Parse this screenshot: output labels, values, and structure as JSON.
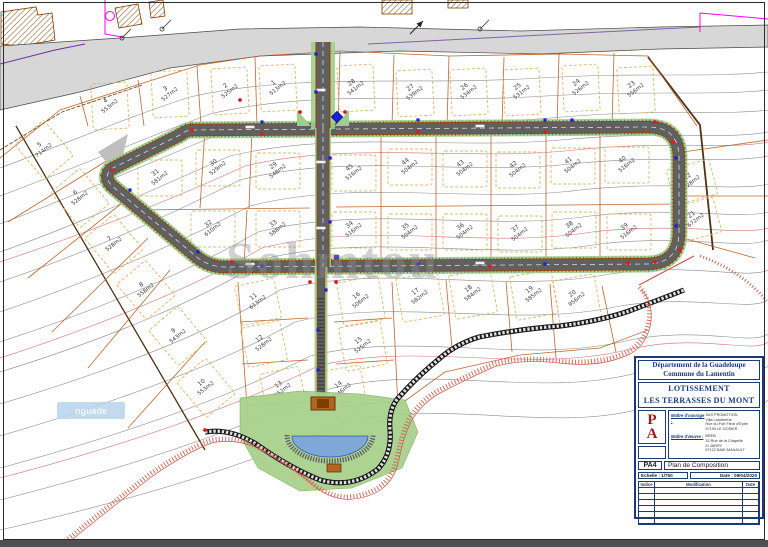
{
  "sheet": {
    "watermark_large": "Sohmtou",
    "watermark_chip": "nguade"
  },
  "title_block": {
    "department": "Département de la Guadeloupe",
    "commune": "Commune du Lamentin",
    "project_line1": "LOTISSEMENT",
    "project_line2": "LES TERRASSES DU MONT",
    "logo_top": "P",
    "logo_bottom": "A",
    "client_label": "Maître d'ouvrage :",
    "client_lines": [
      "SAS PROMOTION",
      "Villa Lamberthe",
      "Rue du Fort Fleur d'Epée",
      "97190 LE GOSIER"
    ],
    "designer_label": "Maître d'œuvre :",
    "designer_lines": [
      "BREB",
      "32 Rue de la Chapelle",
      "ZI JARRY",
      "97122 BAIE-MAHAULT"
    ],
    "doc_code": "PA4",
    "doc_title": "Plan de Composition",
    "scale_label": "Echelle : 1/750",
    "date_label": "Date : 09/04/2020",
    "rev_headers": [
      "Indice",
      "Modification",
      "Date"
    ]
  },
  "colors": {
    "existing_road": "#d7d7d7",
    "asphalt": "#606060",
    "curb_brown": "#8a4a16",
    "verge_green": "#9fce8a",
    "parcel_line": "#b4561e",
    "envelope": "#d9b468",
    "contour": "#666666",
    "contour_red": "#c0504d",
    "water": "#7fa8d9",
    "ravine_red": "#cc6659",
    "wall_black": "#161616",
    "navy": "#1b3a7a",
    "logo_red": "#9b1b1b",
    "magenta": "#ff00ff",
    "violet": "#7030a0"
  },
  "parcels": [
    {
      "n": "1",
      "a": "513m2",
      "x": 276,
      "y": 86
    },
    {
      "n": "2",
      "a": "525m2",
      "x": 228,
      "y": 89
    },
    {
      "n": "3",
      "a": "527m2",
      "x": 168,
      "y": 92
    },
    {
      "n": "4",
      "a": "553m2",
      "x": 108,
      "y": 104
    },
    {
      "n": "5",
      "a": "714m2",
      "x": 42,
      "y": 148
    },
    {
      "n": "6",
      "a": "528m2",
      "x": 78,
      "y": 196
    },
    {
      "n": "7",
      "a": "528m2",
      "x": 112,
      "y": 242
    },
    {
      "n": "8",
      "a": "558m2",
      "x": 144,
      "y": 288
    },
    {
      "n": "9",
      "a": "543m2",
      "x": 176,
      "y": 334
    },
    {
      "n": "10",
      "a": "553m2",
      "x": 204,
      "y": 386
    },
    {
      "n": "11",
      "a": "613m2",
      "x": 256,
      "y": 300
    },
    {
      "n": "12",
      "a": "528m2",
      "x": 262,
      "y": 342
    },
    {
      "n": "13",
      "a": "552m2",
      "x": 281,
      "y": 388
    },
    {
      "n": "14",
      "a": "546m2",
      "x": 341,
      "y": 388
    },
    {
      "n": "15",
      "a": "525m2",
      "x": 361,
      "y": 344
    },
    {
      "n": "16",
      "a": "506m2",
      "x": 359,
      "y": 299
    },
    {
      "n": "17",
      "a": "582m2",
      "x": 418,
      "y": 295
    },
    {
      "n": "18",
      "a": "584m2",
      "x": 471,
      "y": 292
    },
    {
      "n": "19",
      "a": "585m2",
      "x": 532,
      "y": 293
    },
    {
      "n": "20",
      "a": "956m2",
      "x": 575,
      "y": 297
    },
    {
      "n": "21",
      "a": "672m2",
      "x": 694,
      "y": 218
    },
    {
      "n": "22",
      "a": "528m2",
      "x": 690,
      "y": 180
    },
    {
      "n": "23",
      "a": "556m2",
      "x": 634,
      "y": 88
    },
    {
      "n": "24",
      "a": "526m2",
      "x": 579,
      "y": 86
    },
    {
      "n": "25",
      "a": "531m2",
      "x": 520,
      "y": 90
    },
    {
      "n": "26",
      "a": "534m2",
      "x": 467,
      "y": 90
    },
    {
      "n": "27",
      "a": "539m2",
      "x": 413,
      "y": 91
    },
    {
      "n": "28",
      "a": "541m2",
      "x": 354,
      "y": 86
    },
    {
      "n": "29",
      "a": "548m2",
      "x": 276,
      "y": 169
    },
    {
      "n": "30",
      "a": "529m2",
      "x": 216,
      "y": 166
    },
    {
      "n": "31",
      "a": "581m2",
      "x": 158,
      "y": 176
    },
    {
      "n": "32",
      "a": "610m2",
      "x": 211,
      "y": 227
    },
    {
      "n": "33",
      "a": "588m2",
      "x": 276,
      "y": 227
    },
    {
      "n": "34",
      "a": "516m2",
      "x": 352,
      "y": 228
    },
    {
      "n": "35",
      "a": "504m2",
      "x": 408,
      "y": 230
    },
    {
      "n": "36",
      "a": "504m2",
      "x": 463,
      "y": 230
    },
    {
      "n": "37",
      "a": "504m2",
      "x": 518,
      "y": 232
    },
    {
      "n": "38",
      "a": "504m2",
      "x": 572,
      "y": 228
    },
    {
      "n": "39",
      "a": "516m2",
      "x": 627,
      "y": 230
    },
    {
      "n": "40",
      "a": "516m2",
      "x": 625,
      "y": 163
    },
    {
      "n": "41",
      "a": "504m2",
      "x": 571,
      "y": 164
    },
    {
      "n": "42",
      "a": "504m2",
      "x": 516,
      "y": 168
    },
    {
      "n": "43",
      "a": "504m2",
      "x": 463,
      "y": 167
    },
    {
      "n": "44",
      "a": "504m2",
      "x": 408,
      "y": 165
    },
    {
      "n": "45",
      "a": "516m2",
      "x": 352,
      "y": 171
    }
  ]
}
